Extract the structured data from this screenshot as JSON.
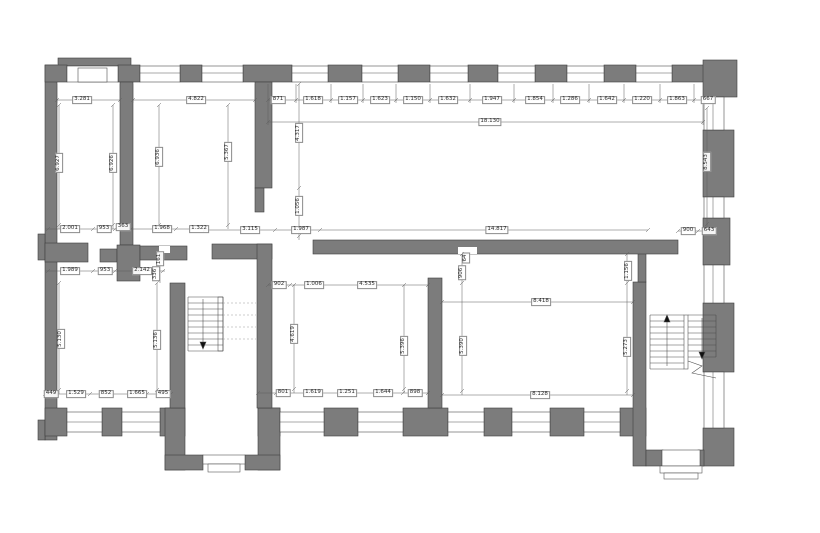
{
  "drawing": {
    "type": "architectural-floor-plan",
    "wall_color": "#7c7c7c",
    "outline_color": "#3f3f3f",
    "dimension_color": "#5f5f5f",
    "background_color": "#ffffff",
    "total_length_label": "18.130"
  },
  "dimension_labels": [
    {
      "text": "3.281",
      "x": 82,
      "y": 100,
      "rot": 0,
      "group": "room-widths"
    },
    {
      "text": "4.822",
      "x": 196,
      "y": 100,
      "rot": 0,
      "group": "room-widths"
    },
    {
      "text": "871",
      "x": 278,
      "y": 100,
      "rot": 0,
      "group": "top-window-chain"
    },
    {
      "text": "1.618",
      "x": 313,
      "y": 100,
      "rot": 0,
      "group": "top-window-chain"
    },
    {
      "text": "1.157",
      "x": 348,
      "y": 100,
      "rot": 0,
      "group": "top-window-chain"
    },
    {
      "text": "1.623",
      "x": 380,
      "y": 100,
      "rot": 0,
      "group": "top-window-chain"
    },
    {
      "text": "1.150",
      "x": 413,
      "y": 100,
      "rot": 0,
      "group": "top-window-chain"
    },
    {
      "text": "1.632",
      "x": 448,
      "y": 100,
      "rot": 0,
      "group": "top-window-chain"
    },
    {
      "text": "1.947",
      "x": 492,
      "y": 100,
      "rot": 0,
      "group": "top-window-chain"
    },
    {
      "text": "1.854",
      "x": 535,
      "y": 100,
      "rot": 0,
      "group": "top-window-chain"
    },
    {
      "text": "1.286",
      "x": 570,
      "y": 100,
      "rot": 0,
      "group": "top-window-chain"
    },
    {
      "text": "1.642",
      "x": 607,
      "y": 100,
      "rot": 0,
      "group": "top-window-chain"
    },
    {
      "text": "1.220",
      "x": 642,
      "y": 100,
      "rot": 0,
      "group": "top-window-chain"
    },
    {
      "text": "1.863",
      "x": 677,
      "y": 100,
      "rot": 0,
      "group": "top-window-chain"
    },
    {
      "text": "667",
      "x": 708,
      "y": 100,
      "rot": 0,
      "group": "top-window-chain"
    },
    {
      "text": "18.130",
      "x": 490,
      "y": 122,
      "rot": 0,
      "group": "overall"
    },
    {
      "text": "6.927",
      "x": 59,
      "y": 163,
      "rot": 90,
      "group": "room-depths"
    },
    {
      "text": "6.926",
      "x": 113,
      "y": 163,
      "rot": 90,
      "group": "room-depths"
    },
    {
      "text": "6.936",
      "x": 159,
      "y": 157,
      "rot": 90,
      "group": "room-depths"
    },
    {
      "text": "5.367",
      "x": 228,
      "y": 152,
      "rot": 90,
      "group": "room-depths"
    },
    {
      "text": "4.317",
      "x": 299,
      "y": 133,
      "rot": 90,
      "group": "room-depths"
    },
    {
      "text": "1.056",
      "x": 299,
      "y": 206,
      "rot": 90,
      "group": "room-depths"
    },
    {
      "text": "8.543",
      "x": 707,
      "y": 162,
      "rot": 90,
      "group": "room-depths"
    },
    {
      "text": "2.001",
      "x": 70,
      "y": 229,
      "rot": 0,
      "group": "mid-chain"
    },
    {
      "text": "953",
      "x": 104,
      "y": 229,
      "rot": 0,
      "group": "mid-chain"
    },
    {
      "text": "363",
      "x": 123,
      "y": 227,
      "rot": 0,
      "group": "mid-chain"
    },
    {
      "text": "1.968",
      "x": 162,
      "y": 229,
      "rot": 0,
      "group": "mid-chain"
    },
    {
      "text": "1.322",
      "x": 199,
      "y": 229,
      "rot": 0,
      "group": "mid-chain"
    },
    {
      "text": "3.115",
      "x": 250,
      "y": 230,
      "rot": 0,
      "group": "mid-chain"
    },
    {
      "text": "1.987",
      "x": 301,
      "y": 230,
      "rot": 0,
      "group": "mid-chain"
    },
    {
      "text": "14.817",
      "x": 497,
      "y": 230,
      "rot": 0,
      "group": "mid-chain"
    },
    {
      "text": "900",
      "x": 688,
      "y": 231,
      "rot": 0,
      "group": "mid-chain"
    },
    {
      "text": "643",
      "x": 709,
      "y": 231,
      "rot": 0,
      "group": "mid-chain"
    },
    {
      "text": "1.989",
      "x": 70,
      "y": 271,
      "rot": 0,
      "group": "corridor-chain"
    },
    {
      "text": "953",
      "x": 105,
      "y": 271,
      "rot": 0,
      "group": "corridor-chain"
    },
    {
      "text": "2.142",
      "x": 142,
      "y": 271,
      "rot": 0,
      "group": "corridor-chain"
    },
    {
      "text": "161",
      "x": 160,
      "y": 259,
      "rot": 90,
      "group": "corridor-chain"
    },
    {
      "text": "336",
      "x": 156,
      "y": 274,
      "rot": 90,
      "group": "corridor-chain"
    },
    {
      "text": "5.130",
      "x": 61,
      "y": 339,
      "rot": 90,
      "group": "room-bl"
    },
    {
      "text": "5.136",
      "x": 157,
      "y": 340,
      "rot": 90,
      "group": "room-bl"
    },
    {
      "text": "449",
      "x": 51,
      "y": 394,
      "rot": 0,
      "group": "room-bl"
    },
    {
      "text": "1.529",
      "x": 76,
      "y": 394,
      "rot": 0,
      "group": "room-bl"
    },
    {
      "text": "852",
      "x": 106,
      "y": 394,
      "rot": 0,
      "group": "room-bl"
    },
    {
      "text": "1.665",
      "x": 137,
      "y": 394,
      "rot": 0,
      "group": "room-bl"
    },
    {
      "text": "495",
      "x": 163,
      "y": 394,
      "rot": 0,
      "group": "room-bl"
    },
    {
      "text": "902",
      "x": 279,
      "y": 285,
      "rot": 0,
      "group": "room-bm"
    },
    {
      "text": "1.006",
      "x": 314,
      "y": 285,
      "rot": 0,
      "group": "room-bm"
    },
    {
      "text": "4.535",
      "x": 367,
      "y": 285,
      "rot": 0,
      "group": "room-bm"
    },
    {
      "text": "4.619",
      "x": 294,
      "y": 334,
      "rot": 90,
      "group": "room-bm"
    },
    {
      "text": "5.396",
      "x": 404,
      "y": 346,
      "rot": 90,
      "group": "room-bm"
    },
    {
      "text": "801",
      "x": 283,
      "y": 393,
      "rot": 0,
      "group": "room-bm"
    },
    {
      "text": "1.619",
      "x": 313,
      "y": 393,
      "rot": 0,
      "group": "room-bm"
    },
    {
      "text": "1.251",
      "x": 347,
      "y": 393,
      "rot": 0,
      "group": "room-bm"
    },
    {
      "text": "1.644",
      "x": 383,
      "y": 393,
      "rot": 0,
      "group": "room-bm"
    },
    {
      "text": "898",
      "x": 415,
      "y": 393,
      "rot": 0,
      "group": "room-bm"
    },
    {
      "text": "906",
      "x": 462,
      "y": 273,
      "rot": 90,
      "group": "room-br"
    },
    {
      "text": "64",
      "x": 466,
      "y": 258,
      "rot": 90,
      "group": "room-br"
    },
    {
      "text": "8.418",
      "x": 541,
      "y": 302,
      "rot": 0,
      "group": "room-br"
    },
    {
      "text": "5.390",
      "x": 463,
      "y": 346,
      "rot": 90,
      "group": "room-br"
    },
    {
      "text": "5.273",
      "x": 627,
      "y": 347,
      "rot": 90,
      "group": "room-br"
    },
    {
      "text": "1.156",
      "x": 628,
      "y": 271,
      "rot": 90,
      "group": "room-br"
    },
    {
      "text": "8.128",
      "x": 540,
      "y": 395,
      "rot": 0,
      "group": "room-br"
    }
  ]
}
